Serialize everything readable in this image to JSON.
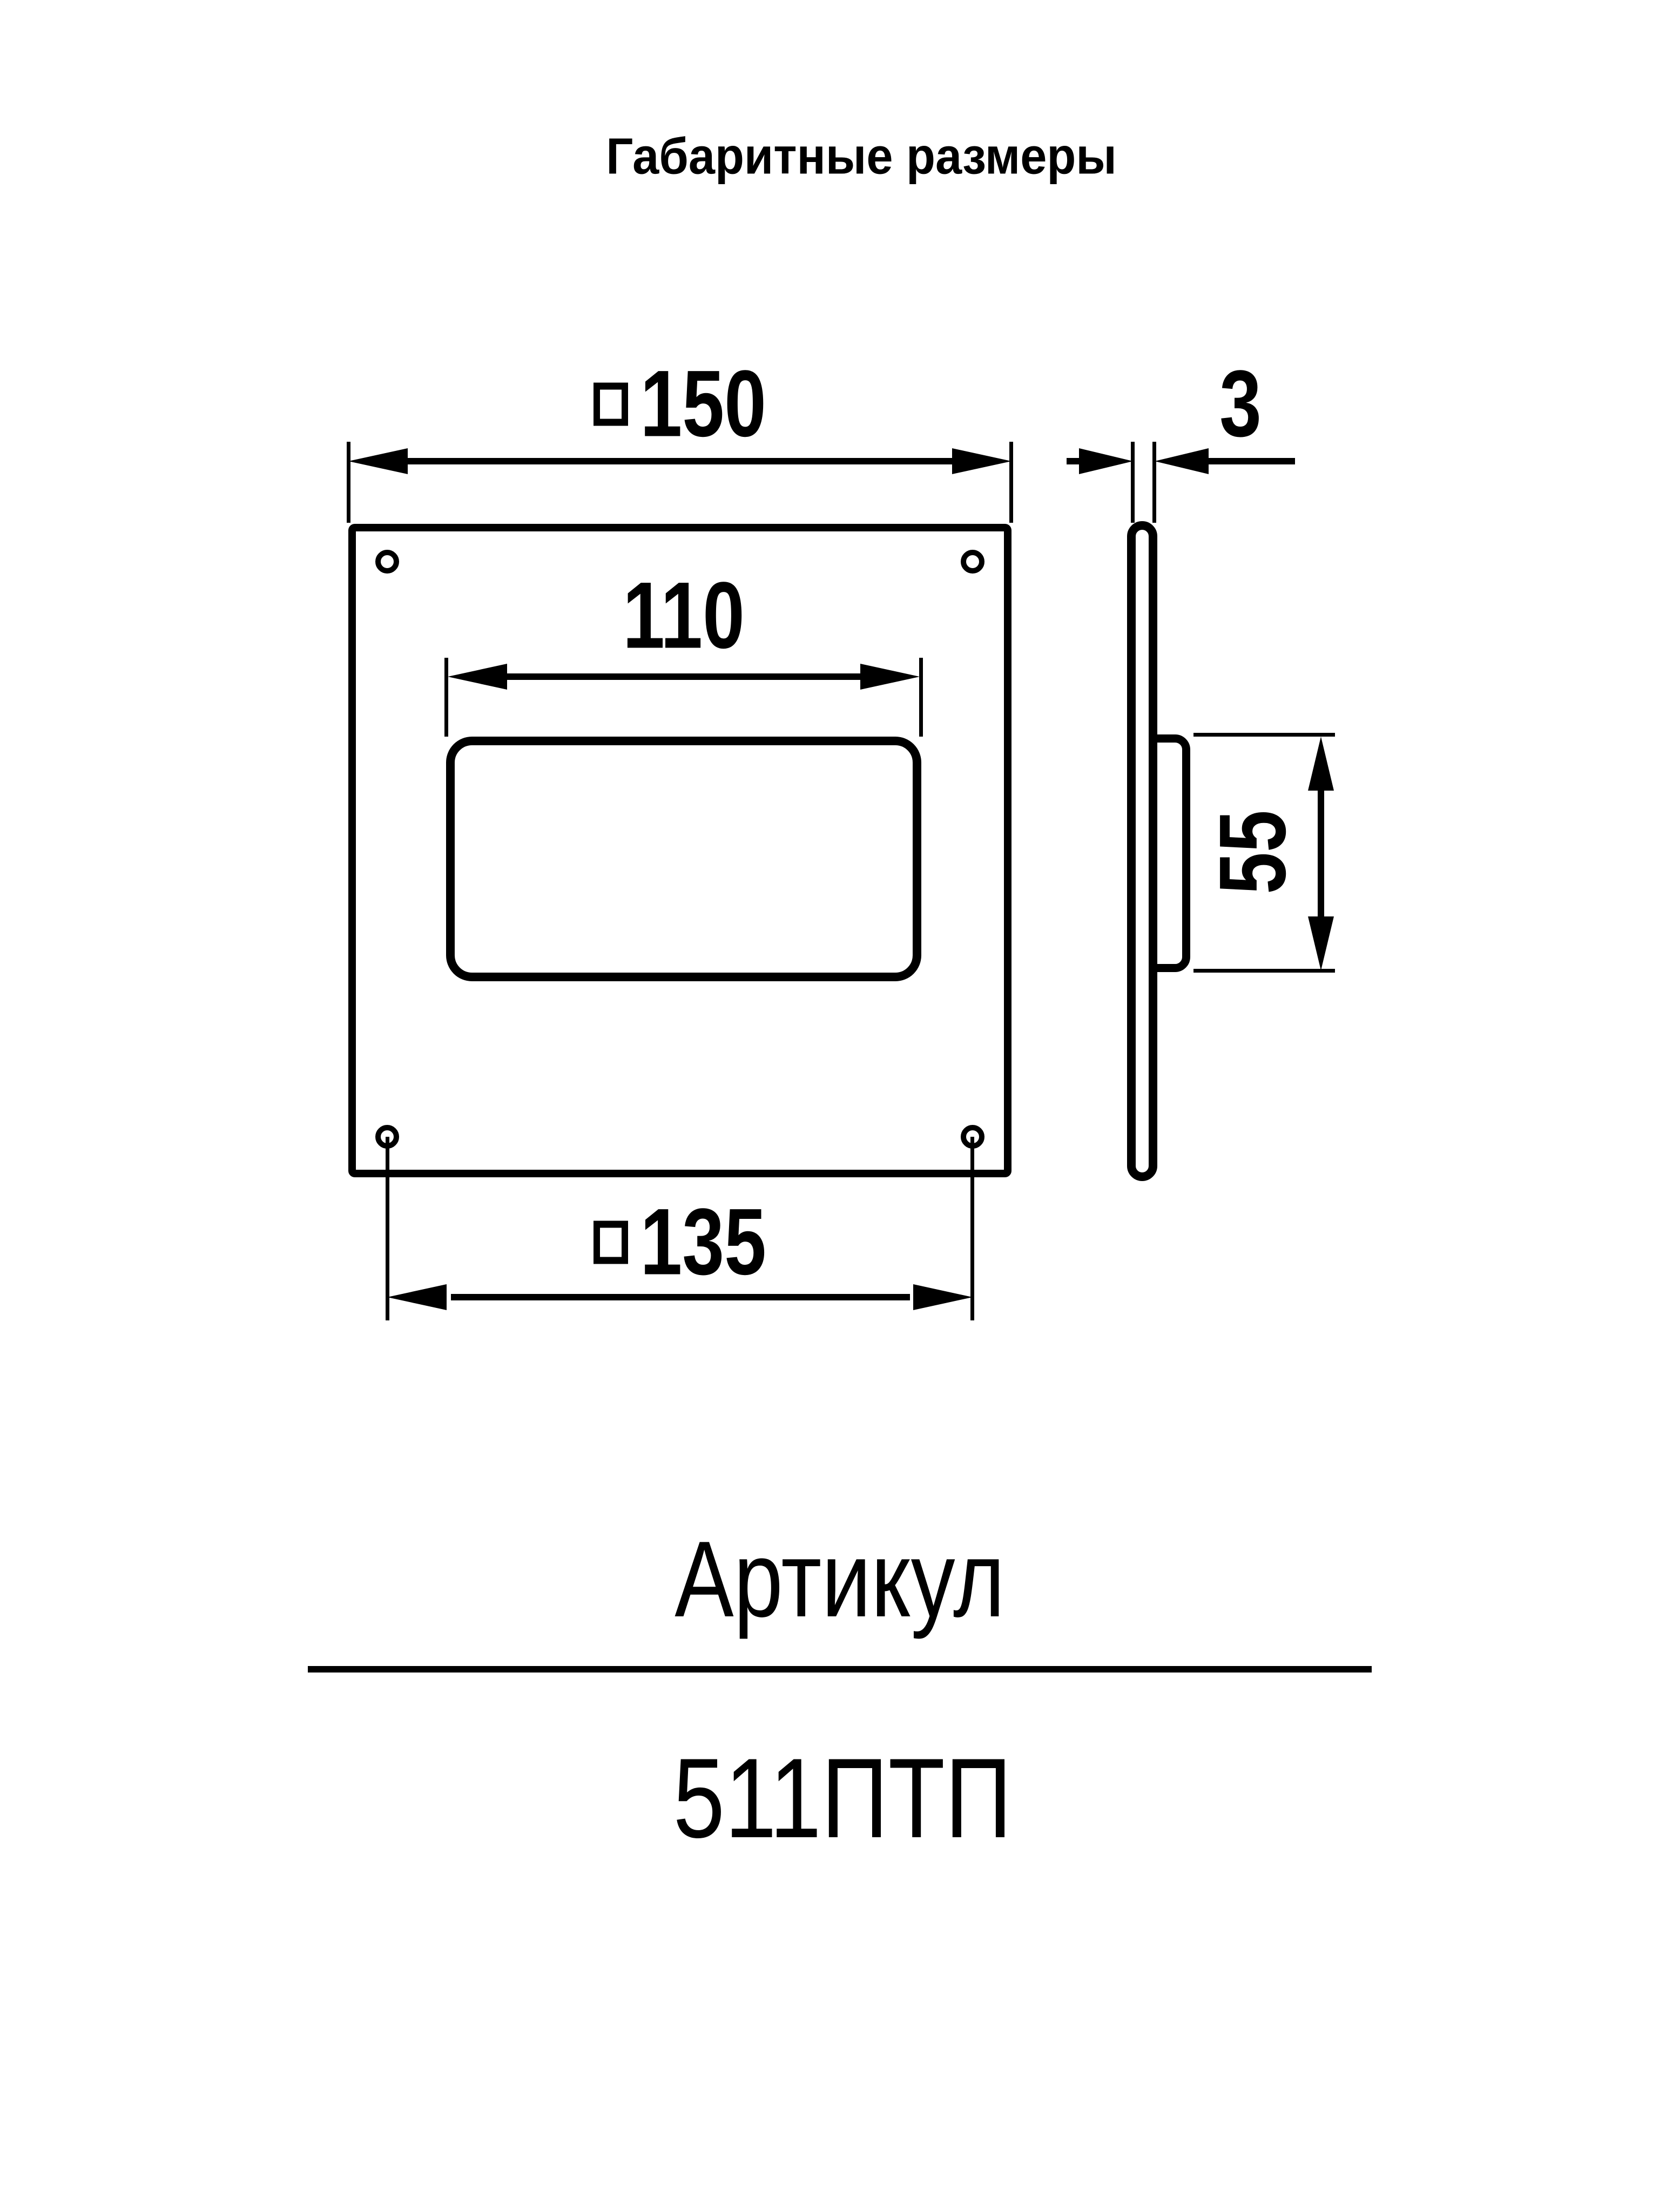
{
  "page": {
    "title": "Габаритные размеры",
    "colors": {
      "ink": "#000000",
      "paper": "#ffffff"
    }
  },
  "drawing": {
    "views": {
      "front": {
        "description": "front view of square flange plate with rectangular duct opening and four corner mounting holes"
      },
      "side": {
        "description": "side profile showing thin plate with duct stub"
      }
    },
    "dims": {
      "outer": {
        "value": "150",
        "symbol": "square"
      },
      "opening": {
        "value": "110",
        "symbol": "none"
      },
      "thickness": {
        "value": "3",
        "symbol": "none"
      },
      "stub_height": {
        "value": "55",
        "symbol": "none"
      },
      "hole_spacing": {
        "value": "135",
        "symbol": "square"
      }
    }
  },
  "article": {
    "heading": "Артикул",
    "code": "511ПТП"
  }
}
